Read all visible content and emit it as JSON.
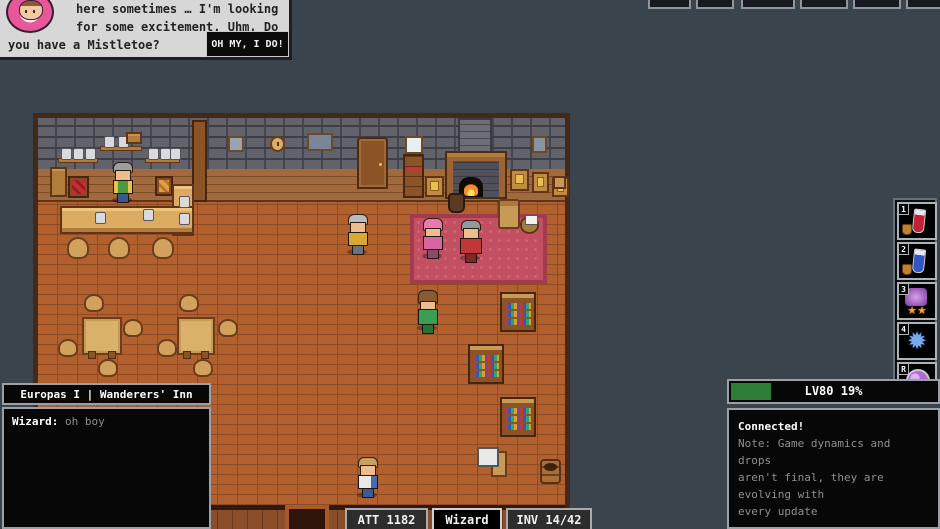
{
  "dialog": {
    "lines": [
      "here sometimes … I'm looking",
      "for some excitement. Uhm, Do",
      "you have a Mistletoe?"
    ],
    "button": "OH MY, I DO!"
  },
  "top_bar": {
    "slot_count": 6
  },
  "hotbar": {
    "slots": [
      {
        "key": "1",
        "icon": "red-potion"
      },
      {
        "key": "2",
        "icon": "blue-potion"
      },
      {
        "key": "3",
        "icon": "star-summon-skill"
      },
      {
        "key": "4",
        "icon": "frost-burst-skill"
      },
      {
        "key": "R",
        "icon": "arcane-orb-skill"
      }
    ]
  },
  "chat": {
    "title": "Europas I | Wanderers' Inn",
    "messages": [
      {
        "author": "Wizard:",
        "text": "oh boy"
      }
    ]
  },
  "level_panel": {
    "level_text": "LV80 19%",
    "progress_percent": 19,
    "bar_color": "#2e7d36",
    "lines": [
      "Connected!",
      "Note: Game dynamics and drops",
      "aren't final, they are evolving with",
      "every update"
    ]
  },
  "status_bar": {
    "attack": "ATT 1182",
    "class": "Wizard",
    "inventory": "INV 14/42"
  },
  "colors": {
    "xp_green": "#2e7d36",
    "carpet_red": "#c25062",
    "ui_border_gray": "#9aa0a6",
    "background": "#39444d"
  }
}
